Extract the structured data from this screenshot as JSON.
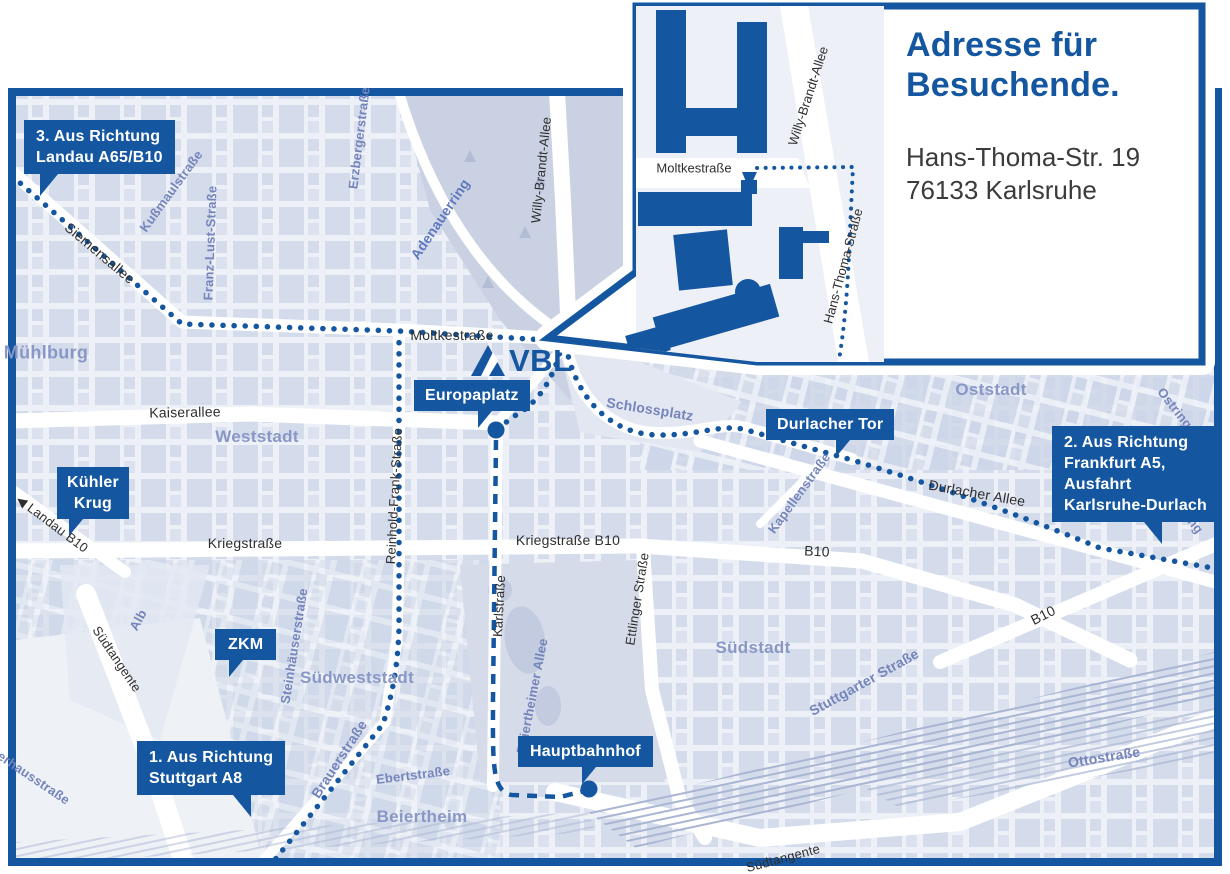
{
  "colors": {
    "accent_blue": "#1456a0",
    "map_background": "#e9edf4",
    "city_blocks": "#cdd6e8",
    "park": "#c9d1e2",
    "railway": "#a9b5d2",
    "road": "#ffffff",
    "area_label": "#8997c6",
    "street_label_dark": "#2e2e2e",
    "street_label_blue": "#7585bb",
    "route_dots": "#1456a0"
  },
  "inset": {
    "title_lines": [
      "Adresse für",
      "Besuchende."
    ],
    "address_lines": [
      "Hans-Thoma-Str. 19",
      "76133 Karlsruhe"
    ],
    "labels": {
      "moltkestrasse": "Moltkestraße",
      "willy_brandt_allee": "Willy-Brandt-Allee",
      "hans_thoma_strasse": "Hans-Thoma-Straße"
    }
  },
  "logo": {
    "text": "VBL"
  },
  "misc": {
    "landau_arrow": "◀"
  },
  "callouts": {
    "landau": {
      "lines": [
        "3. Aus Richtung",
        "Landau A65/B10"
      ]
    },
    "frankfurt": {
      "lines": [
        "2. Aus Richtung",
        "Frankfurt A5,",
        "Ausfahrt",
        "Karlsruhe-Durlach"
      ]
    },
    "stuttgart": {
      "lines": [
        "1. Aus Richtung",
        "Stuttgart A8"
      ]
    },
    "europaplatz": {
      "lines": [
        "Europaplatz"
      ]
    },
    "durlacher_tor": {
      "lines": [
        "Durlacher Tor"
      ]
    },
    "kuehler_krug": {
      "lines": [
        "Kühler",
        "Krug"
      ]
    },
    "zkm": {
      "lines": [
        "ZKM"
      ]
    },
    "hauptbahnhof": {
      "lines": [
        "Hauptbahnhof"
      ]
    }
  },
  "streets": {
    "siemensallee": "Siemensallee",
    "moltkestrasse": "Moltkestraße",
    "kaiserallee": "Kaiserallee",
    "kriegstrasse": "Kriegstraße",
    "kriegstrasse_b10": "Kriegstraße B10",
    "willy_brandt_allee": "Willy-Brandt-Allee",
    "reinhold_frank_strasse": "Reinhold-Frank-Straße",
    "karlstrasse": "Karlstraße",
    "ettlinger_strasse": "Ettlinger Straße",
    "durlacher_allee": "Durlacher Allee",
    "b10_west": "B10",
    "b10_east": "B10",
    "landau_b10": "Landau B10",
    "suedtangente_west": "Südtangente",
    "suedtangente_sued": "Südtangente",
    "kussmaulstrasse": "Kußmaulstraße",
    "franz_lust_strasse": "Franz-Lust-Straße",
    "erzbergerstrasse": "Erzbergerstraße",
    "adenauerring": "Adenauerring",
    "schlossplatz": "Schlossplatz",
    "kapellenstrasse": "Kapellenstraße",
    "ostring_nord": "Ostring",
    "ostring_sued": "Ostring",
    "steinhaeuserstrasse": "Steinhäuserstraße",
    "brauerstrasse": "Brauerstraße",
    "ebertstrasse": "Ebertstraße",
    "beiertheimer_allee": "Beiertheimer Allee",
    "alb": "Alb",
    "stuttgarter_strasse": "Stuttgarter Straße",
    "ottostrasse": "Ottostraße",
    "pulverhausstrasse": "Pulverhausstraße"
  },
  "areas": {
    "muehlburg": "Mühlburg",
    "weststadt": "Weststadt",
    "oststadt": "Oststadt",
    "suedstadt": "Südstadt",
    "suedweststadt": "Südweststadt",
    "beiertheim": "Beiertheim"
  }
}
